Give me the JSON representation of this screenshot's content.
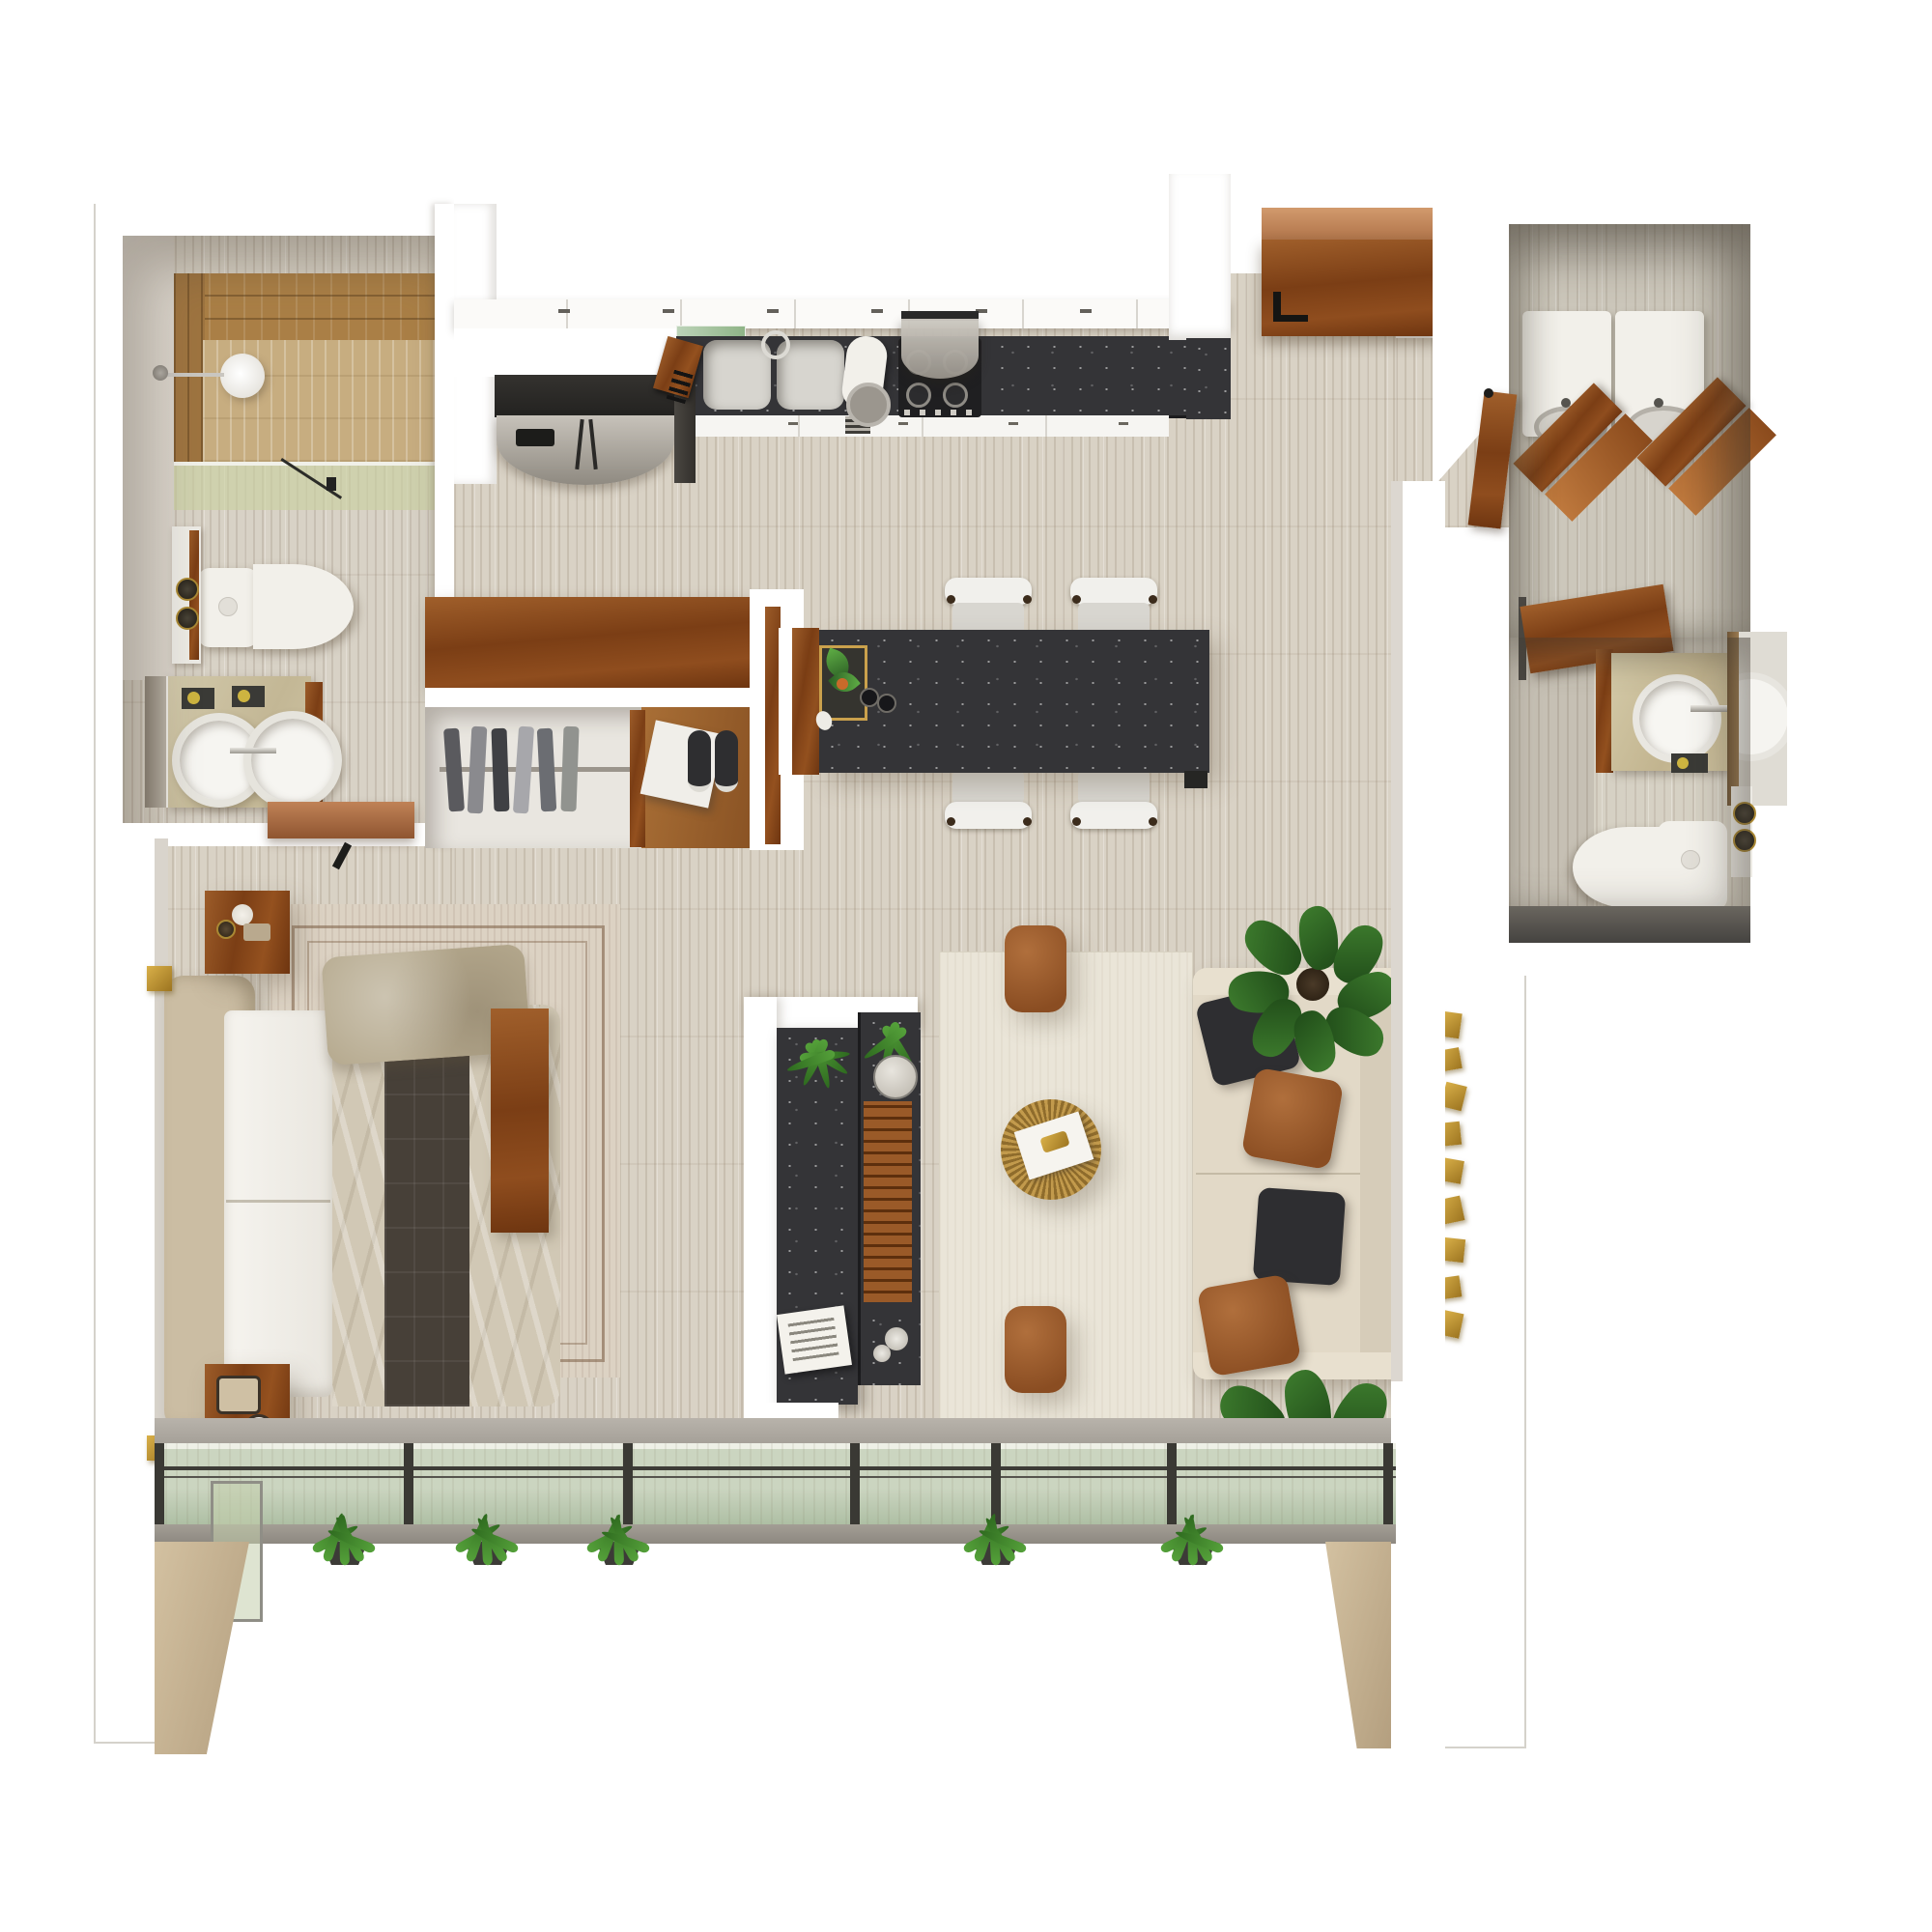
{
  "scene": {
    "type": "3d-floor-plan-top-view",
    "description": "Photorealistic top-down 3D render of a studio apartment floor plan on a white background, travertine floors, walnut wood accents, black stone counters, glass-floor balcony edge with hanging ferns",
    "visible_text": "none"
  },
  "palette": {
    "floor": "#d9d2c5",
    "wall": "#ffffff",
    "granite": "#343437",
    "walnutLight": "#9c5c29",
    "walnutDark": "#7b3e15",
    "copper": "#c08257",
    "oak": "#aa7f46",
    "shower_stone": "#c7ad80",
    "glass": "#cbd5c0",
    "fascia": "#9a958c",
    "column_stone": "#c8b592",
    "fixture_white": "#f2f0ea",
    "sofa": "#e2d9c7",
    "leather": "#9a5a2e",
    "pillow_black": "#2e2e31",
    "plantL": "#5fae45",
    "plantD": "#2b5e24",
    "gold": "#c8a03e",
    "rug_living": "#eae5d8",
    "rug_bedroom": "#dcd2c3",
    "duvet": "#d1c8b5",
    "runner": "#474038",
    "headboard": "#cbbda3",
    "stainless": "#b9b5ad"
  },
  "rooms": [
    {
      "name": "Main bathroom",
      "furniture": [
        "walk-in shower with wood walls",
        "rain shower head",
        "glass partition",
        "toilet",
        "wall shelf with bottles",
        "stone vanity with round vessel sinks",
        "wall mirror",
        "copper wood door"
      ]
    },
    {
      "name": "Kitchen",
      "furniture": [
        "stainless french-door refrigerator",
        "white upper cabinets",
        "glass shelf",
        "knife block",
        "double sink",
        "chrome faucet",
        "stand mixer",
        "gas cooktop",
        "range hood",
        "white base cabinets",
        "black stone countertop"
      ]
    },
    {
      "name": "Entry",
      "furniture": [
        "open walnut entry door",
        "copper door header"
      ]
    },
    {
      "name": "Dining island",
      "furniture": [
        "black stone island table",
        "four white chairs",
        "gold tray with plant",
        "two cups"
      ]
    },
    {
      "name": "Walk-in closet",
      "furniture": [
        "walnut wardrobe cabinet",
        "clothes rail with hanging clothes",
        "wood divider",
        "white storage box",
        "pair of sneakers"
      ]
    },
    {
      "name": "Bedroom",
      "furniture": [
        "upholstered headboard",
        "double bed",
        "white sheets",
        "beige duvet",
        "dark quilted runner",
        "khaki pillow",
        "walnut foot bench",
        "bordered area rug",
        "two walnut nightstands",
        "candle and bottles",
        "alarm clock",
        "two gold wall sconces"
      ]
    },
    {
      "name": "Media partition",
      "furniture": [
        "white partition wall",
        "double-sided black stone media console",
        "two ferns",
        "marble discs",
        "wood slat panel",
        "magazine stack"
      ]
    },
    {
      "name": "Living room",
      "furniture": [
        "cream area rug",
        "round rattan coffee table",
        "magazine with gold object",
        "two cognac leather poufs",
        "beige fabric sofa",
        "two black pillows",
        "two cognac leather pillows",
        "two potted fiddle-leaf plants",
        "gold metal wall art"
      ]
    },
    {
      "name": "Laundry room",
      "furniture": [
        "washer",
        "dryer",
        "two folding wood racks",
        "walnut door"
      ]
    },
    {
      "name": "Guest bathroom",
      "furniture": [
        "walnut vanity",
        "round vessel sink",
        "chrome faucet",
        "wall mirror",
        "toilet",
        "shelf with bottles",
        "walnut door"
      ]
    },
    {
      "name": "Balcony glass edge",
      "furniture": [
        "glass floor panels",
        "dark metal mullions",
        "five hanging fern planters",
        "two beige stone columns"
      ]
    }
  ]
}
